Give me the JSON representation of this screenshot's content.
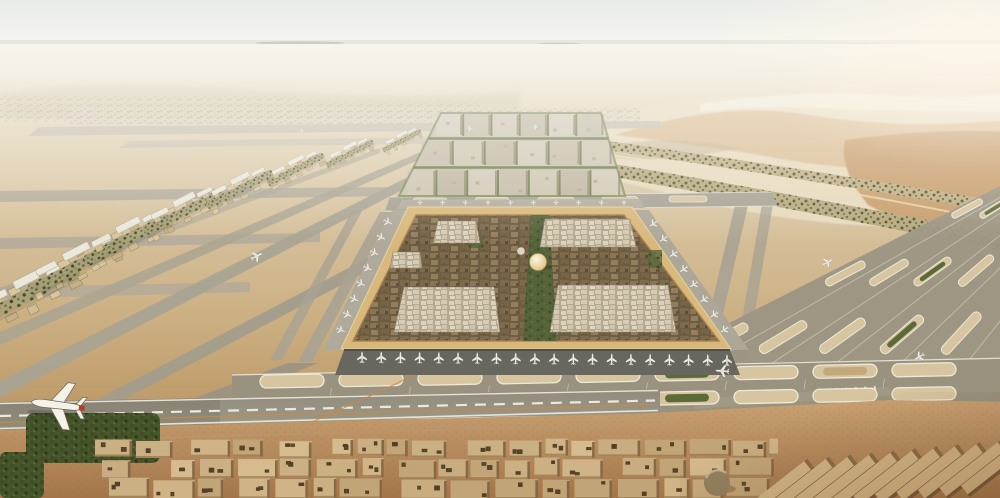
{
  "meta": {
    "title": "Aerial architectural rendering of a vast desert airport city: a square walled terminal oasis of dense mud-brown buildings and greenery with a central golden dome, surrounded by grey runways and taxiways, a gridded support district behind, sand dunes with a green wadi to the right, and low-rise city blocks in the foreground with a taxiing airliner"
  },
  "palette": {
    "gold": "#d9b87c",
    "goldLight": "#f0d9a6",
    "goldShadow": "#a97f49",
    "termBase": "#6f5d42",
    "greenAxis": "#55633a",
    "greenIsle": "#5c6a37",
    "greenStreet": "#66763f",
    "apron": "#67665f",
    "apronEdge": "#4e4d47",
    "sandIsle": "#d7c5a0",
    "orange": "#d08a3e",
    "taxiGrey": "#a9a392",
    "taxiGreyFar": "#c5beac",
    "treeBase": "#46542a",
    "marking": "#efece0",
    "duneLight": "#e7d9bc",
    "duneShadow": "#d9bc90",
    "duneDeep": "#c89e6c",
    "warehouseTop": "#d3b787",
    "planeBody": "#f3f1e8",
    "planeTailRed": "#b23c2d",
    "settlement_tones": [
      "#d8c69e",
      "#cfbd94",
      "#c4b189"
    ],
    "district_tones": [
      "#d1c9b5",
      "#c5bca6",
      "#cdc5af",
      "#c0b7a1"
    ],
    "city_tones": [
      "#d0b487",
      "#c9ad80",
      "#d6bb8e",
      "#c2a577",
      "#cbb083"
    ]
  },
  "scene": {
    "seed": 11,
    "aircraft": [
      {
        "x": 57,
        "y": 405,
        "s": 2.35,
        "r": 187,
        "tail": "#b23c2d",
        "shadow": true
      },
      {
        "x": 257,
        "y": 256,
        "s": 0.55,
        "r": -28
      },
      {
        "x": 470,
        "y": 129,
        "s": 0.3,
        "r": 2
      },
      {
        "x": 536,
        "y": 127,
        "s": 0.28,
        "r": 2
      },
      {
        "x": 302,
        "y": 131,
        "s": 0.22,
        "r": 0
      },
      {
        "x": 722,
        "y": 371,
        "s": 0.6,
        "r": 184
      },
      {
        "x": 828,
        "y": 262,
        "s": 0.5,
        "r": -30
      },
      {
        "x": 919,
        "y": 357,
        "s": 0.5,
        "r": 150
      }
    ],
    "gate_rows": [
      {
        "x1": 362,
        "y1": 357,
        "x2": 727,
        "y2": 360,
        "n": 20,
        "r": -90,
        "s": 0.5
      },
      {
        "x1": 399,
        "y1": 224,
        "x2": 352,
        "y2": 332,
        "n": 8,
        "r": 25,
        "s": 0.42,
        "ox": -11,
        "oy": -2
      },
      {
        "x1": 642,
        "y1": 226,
        "x2": 713,
        "y2": 332,
        "n": 8,
        "r": 146,
        "s": 0.42,
        "ox": 11,
        "oy": -2
      },
      {
        "x1": 420,
        "y1": 203,
        "x2": 624,
        "y2": 203,
        "n": 10,
        "r": 90,
        "s": 0.26
      }
    ],
    "ovals": {
      "n": 9,
      "x0": 292,
      "step": 79,
      "y1": 381,
      "y2": 405,
      "drift": -1.4,
      "inner1": [
        null,
        null,
        null,
        null,
        null,
        "#5c6a37",
        null,
        "#c2a87b",
        null
      ],
      "inner2": [
        null,
        null,
        null,
        "#b7a06d",
        null,
        "#5c6a37",
        null,
        null,
        null
      ]
    },
    "fan": {
      "vp": [
        1180,
        95
      ],
      "x0": 640,
      "step": 66,
      "lanes": 6,
      "fractions": [
        0.1,
        0.34,
        0.58
      ]
    },
    "settlements": [
      {
        "x": 28,
        "y": 297,
        "s": 1.2
      },
      {
        "x": 76,
        "y": 268,
        "s": 1.1
      },
      {
        "x": 128,
        "y": 240,
        "s": 1.0
      },
      {
        "x": 184,
        "y": 213,
        "s": 0.9
      },
      {
        "x": 240,
        "y": 190,
        "s": 0.78
      },
      {
        "x": 296,
        "y": 170,
        "s": 0.66
      },
      {
        "x": 350,
        "y": 154,
        "s": 0.55
      },
      {
        "x": 402,
        "y": 141,
        "s": 0.45
      }
    ],
    "district": {
      "yTop": 113,
      "yBot": 196,
      "topL": 441,
      "topR": 601,
      "botL": 399,
      "botR": 625,
      "rows": [
        {
          "y0": 114,
          "y1": 136,
          "n": 6
        },
        {
          "y0": 141,
          "y1": 165,
          "n": 6
        },
        {
          "y0": 170,
          "y1": 196,
          "n": 7
        }
      ]
    },
    "city": {
      "x0": 95,
      "x1": 772,
      "rows": [
        {
          "y": 440,
          "h": 17
        },
        {
          "y": 459,
          "h": 19
        },
        {
          "y": 479,
          "h": 20
        }
      ]
    },
    "warehouses": {
      "n": 11,
      "x0": 780,
      "y0": 487,
      "dx": 21.5,
      "dy": -2.1,
      "len": 78,
      "w": 11,
      "rot": -38
    }
  }
}
